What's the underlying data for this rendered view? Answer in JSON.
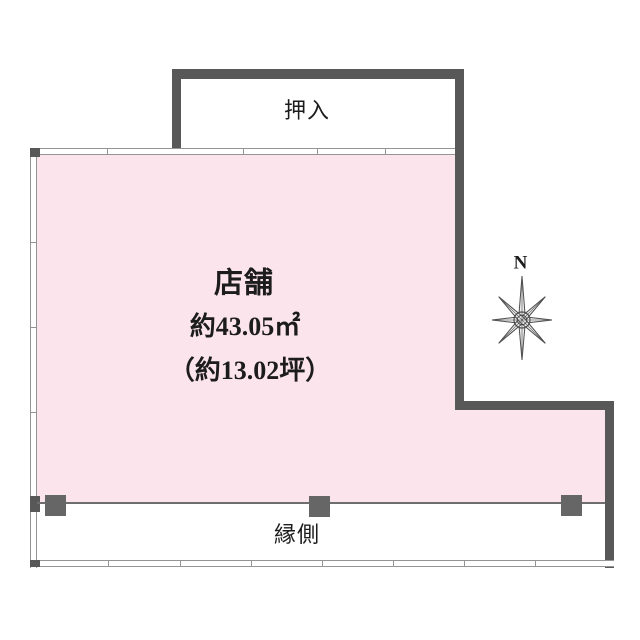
{
  "rooms": {
    "shop": {
      "label": "店舗",
      "area_m2": "約43.05㎡",
      "area_tsubo": "（約13.02坪）"
    },
    "closet": {
      "label": "押入"
    },
    "veranda": {
      "label": "縁側"
    }
  },
  "compass": {
    "north_label": "N"
  },
  "colors": {
    "room_fill": "#fce4ec",
    "wall": "#585858",
    "pillar": "#666666",
    "window_line": "#949494",
    "veranda_boundary": "#6e6e6e",
    "text": "#1c1c1c",
    "background": "#ffffff"
  }
}
